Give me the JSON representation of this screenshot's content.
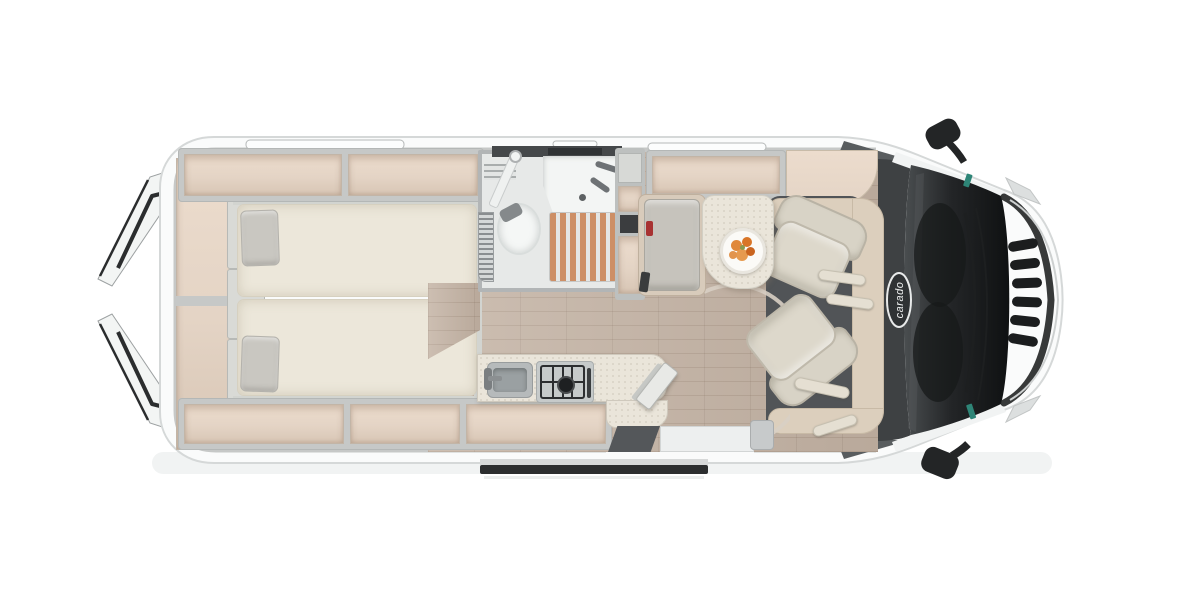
{
  "branding": {
    "logo_text": "carado"
  },
  "palette": {
    "background": "#ffffff",
    "body_white": "#fafbfb",
    "wall_grey": "#c6c8c7",
    "locker_tan": "#e4d4c5",
    "mattress_cream": "#ece7da",
    "pillow_grey": "#c9c7c1",
    "floor_wood": "#c3b2a3",
    "shower_slat": "#cd8f66",
    "bathroom_floor": "#e7e9e8",
    "counter_cream": "#eae5da",
    "seat_fabric": "#d8d3c6",
    "cab_trim": "#dccfbd",
    "cab_floor": "#515457",
    "windshield_dark": "#1d1f21",
    "sticker_teal": "#2e8577",
    "fruit_orange": "#e0883a",
    "belt_red": "#a83232"
  },
  "legend": {
    "items": [
      "open-rear-doors",
      "twin-beds",
      "overhead-lockers",
      "wardrobe-shelves",
      "bathroom-with-shower-toilet-basin",
      "tall-cabinet",
      "dinette-bench",
      "table-with-fruit-plate",
      "kitchen-sink-and-hob",
      "swivel-cab-seats",
      "cab-with-windshield",
      "side-mirrors",
      "open-sliding-door"
    ]
  }
}
